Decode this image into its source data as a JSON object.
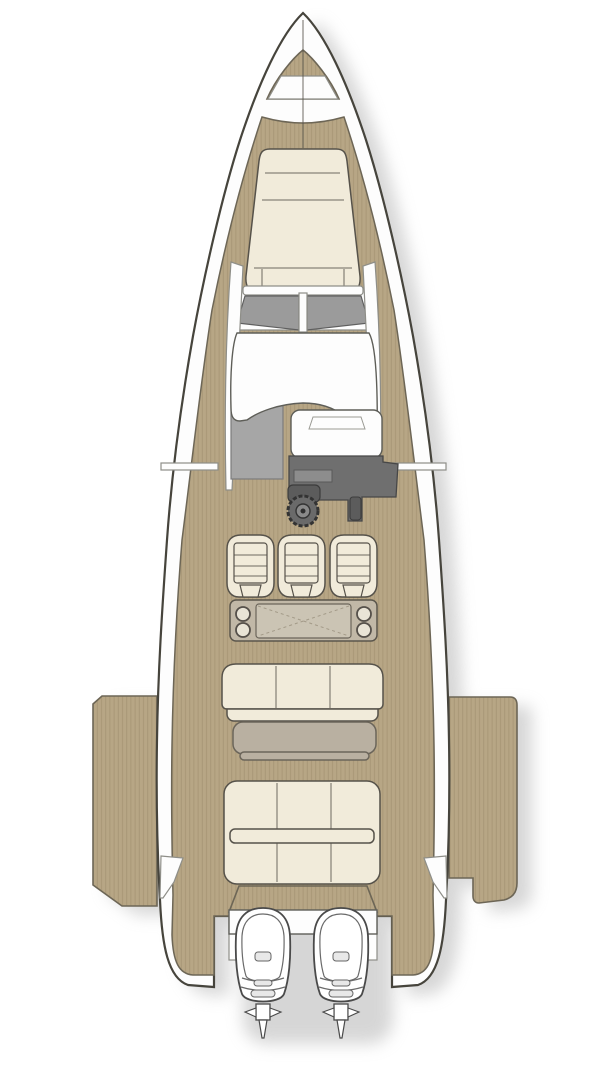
{
  "title": "Motor boat deck plan — top view general arrangement",
  "image_type": "boat-floorplan-illustration",
  "palette": {
    "background": "#ffffff",
    "hull_white": "#fdfdfd",
    "outline_dark": "#46443c",
    "outline_mid": "#6d6656",
    "outline_soft": "#8e8e88",
    "teak": "#b7a685",
    "teak_line": "#9c8b6b",
    "cushion_cream": "#f1ebda",
    "cushion_seam": "#56524a",
    "glass_gray": "#9b9b9b",
    "console_gray": "#6f6f6f",
    "console_light": "#8d8d8d",
    "floor_gray": "#a6a6a6",
    "table_taupe": "#b9b0a1",
    "module_taupe": "#c1b8a7",
    "table_top": "#cbc4b4",
    "shadow": "#bcbcbc"
  },
  "vessel": {
    "orientation": "bow at top, stern with twin outboard engines at bottom",
    "decking": "teak planking",
    "components": {
      "anchor_locker": {
        "label": "Bow anchor locker hatch"
      },
      "bow_sunpad": {
        "label": "Bow sunpad with seam-divided cushions",
        "sections": 3
      },
      "windshield": {
        "label": "Wraparound windshield",
        "glass_panels": 2
      },
      "hardtop": {
        "label": "White console cowl below windshield"
      },
      "companionway": {
        "label": "Grey cabin-entry step area port of console"
      },
      "helm_console": {
        "label": "Helm console",
        "details": [
          "instrument display",
          "steering wheel",
          "throttle lever"
        ]
      },
      "helm_seats": {
        "label": "Helm bucket seats",
        "count": 3
      },
      "wet_bar": {
        "label": "Aft-facing unit with folding table",
        "cup_holders": 4
      },
      "cockpit_sofa": {
        "label": "Cockpit bench sofa",
        "cushions": 3
      },
      "cockpit_table": {
        "label": "Cockpit table with lower leaf"
      },
      "aft_sunpad": {
        "label": "Aft sunpad",
        "cushions": 6
      },
      "side_terrace_port": {
        "label": "Port fold-down terrace"
      },
      "side_terrace_starboard": {
        "label": "Starboard fold-down terrace"
      },
      "engine_bracket": {
        "label": "Transom engine bracket"
      },
      "outboard_engines": {
        "label": "Outboard engines",
        "count": 2
      }
    }
  }
}
